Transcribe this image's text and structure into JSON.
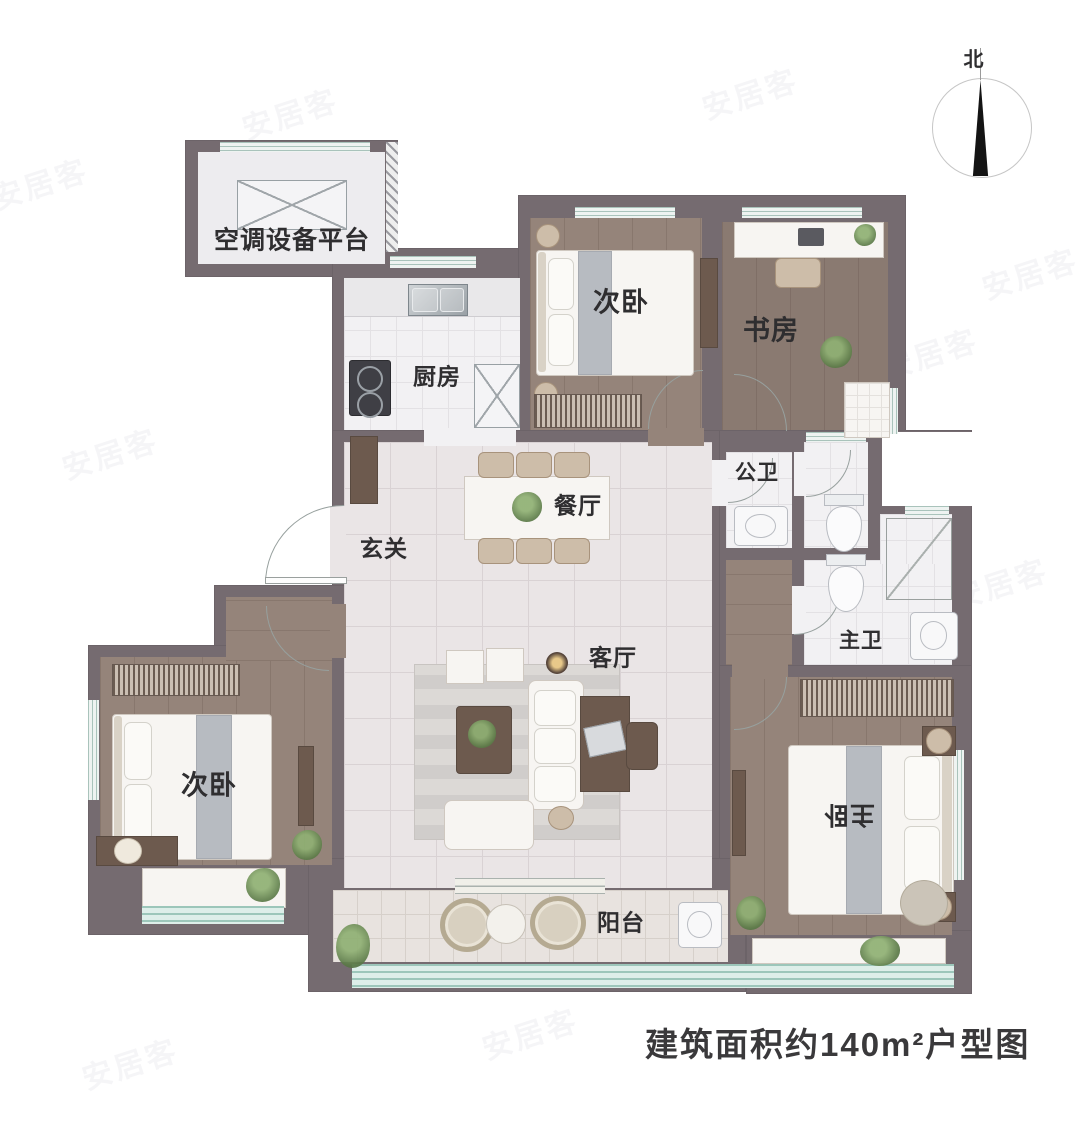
{
  "caption": "建筑面积约140m²户型图",
  "compass": {
    "north": "北"
  },
  "watermark": {
    "text": "安居客"
  },
  "rooms": {
    "ac_platform": {
      "label": "空调设备平台"
    },
    "kitchen": {
      "label": "厨房"
    },
    "bedroom_top": {
      "label": "次卧"
    },
    "study": {
      "label": "书房"
    },
    "public_bath": {
      "label": "公卫"
    },
    "master_bath": {
      "label": "主卫"
    },
    "entry": {
      "label": "玄关"
    },
    "dining": {
      "label": "餐厅"
    },
    "living": {
      "label": "客厅"
    },
    "bedroom_left": {
      "label": "次卧"
    },
    "master_bedroom": {
      "label": "主卧"
    },
    "balcony": {
      "label": "阳台"
    }
  }
}
